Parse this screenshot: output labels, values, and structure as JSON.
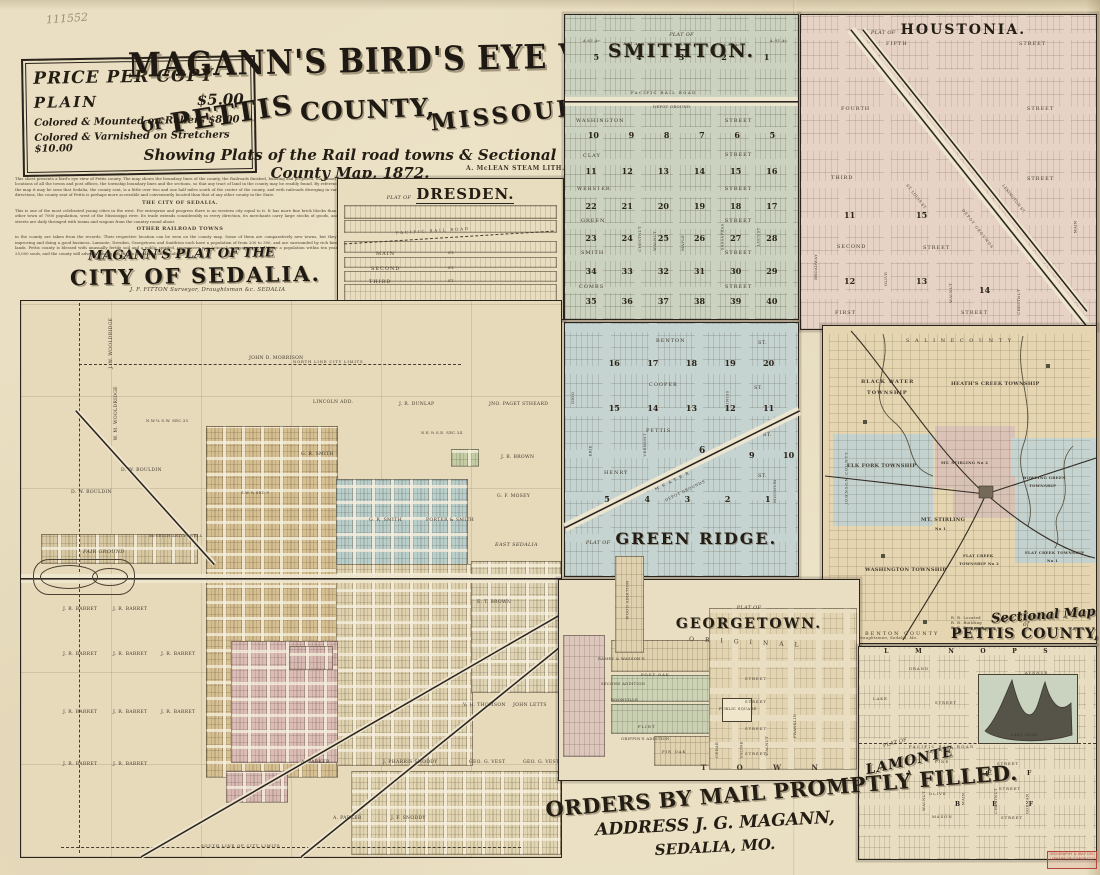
{
  "page": {
    "handwritten_number": "111552"
  },
  "price_box": {
    "title": "PRICE PER COPY",
    "plain_label": "PLAIN",
    "plain_price": "$5.00",
    "row2": "Colored & Mounted on Rollers  $8.00",
    "row3": "Colored & Varnished on Stretchers $10.00"
  },
  "title_block": {
    "main": "MAGANN'S BIRD'S EYE VIEW",
    "of": "OF",
    "pettis": "PETTIS",
    "county": "COUNTY,",
    "missouri": "MISSOURI",
    "subtitle": "Showing Plats of the Rail road towns & Sectional County Map, 1872.",
    "lith": "A. McLEAN STEAM LITH."
  },
  "description": {
    "para1": "This sheet presents a bird's eye view of Pettis county. The map shows the boundary lines of the county, the Railroads finished, building and proposed, the names and locations of all the towns and post offices, the township boundary lines and the sections, so that any tract of land in the county may be readily found. By reference to the map it may be seen that Sedalia, the county seat, is a little over two and one half miles south of the center of the county, and with railroads diverging in various directions, the county seat of Pettis is perhaps more accessible and conveniently located than that of any other county in the State.",
    "heading1": "THE CITY OF SEDALIA.",
    "para2": "This is one of the most celebrated young cities in the west. For enterprise and progress there is no western city equal to it. It has more fine brick blocks than any other town of 7000 population, west of the Mississippi river. Its trade extends considerably in every direction, its merchants carry large stocks of goods, and its streets are daily thronged with teams and wagons from the country round about.",
    "heading2": "OTHER RAILROAD TOWNS",
    "para3": "in the county are taken from the records. Their respective location can be seen on the county map. Some of them are comparatively new towns, but they are improving and doing a good business. Lamonte, Dresden, Georgetown and Smithton each have a population of from 200 to 300, and are surrounded by rich farming lands. Pettis county is blessed with unusually fertile soil and a public spirited, progressive population; her county seat will have a population within ten years of 25,000 souls, and the county will advance among the first in population and wealth."
  },
  "dresden": {
    "prefix": "PLAT OF",
    "title": "DRESDEN.",
    "railroad": "PACIFIC  RAIL  ROAD",
    "streets": [
      "MAIN",
      "SECOND",
      "THIRD"
    ],
    "st": "ST.",
    "west": "WESTERN DIVISION",
    "east": "EASTERN DIVISION"
  },
  "sedalia": {
    "t1": "MAGANN'S PLAT OF THE",
    "t2": "CITY OF SEDALIA.",
    "surveyor": "J. F. FITTON   Surveyor, Draughtsman &c.   SEDALIA",
    "labels": [
      "J. W. WOOLDRIDGE",
      "W. M. WOOLDRIDGE",
      "JOHN D. MORRISON",
      "NORTH LINE CITY LIMITS",
      "LINCOLN ADD.",
      "J. R. DUNLAP",
      "JNO. PAGET STHEARD",
      "G. R. SMITH",
      "J. B. BROWN",
      "D. W. BOULDIN",
      "D. W. BOULDIN",
      "G. R. SMITH",
      "PORTER & SMITH",
      "G. F. MOSEY",
      "EAST SEDALIA",
      "E. T. BROWN",
      "FAIR GROUND",
      "McVEIGH AND POWELL",
      "J. R. BARRET",
      "J. R. BARRET",
      "J. R. BARRET",
      "J. R. BARRET",
      "J. R. BARRET",
      "J. R. BARRET",
      "J. R. BARRET",
      "J. R. BARRET",
      "V. H. THOMSON",
      "JOHN LETTS",
      "A. PARKER",
      "J. PHARRIS SNODDY",
      "GEO. G. VEST",
      "GEO. G. VEST",
      "A. PARKER",
      "J. F. SNODDY",
      "SOUTH LINE OF CITY LIMITS",
      "N.W.¼ S.W. SEC.33",
      "N.E.¼ S.E. SEC.34",
      "S.W.¼ SEC.9",
      "J. R. BARRET",
      "J. R. BARRET"
    ]
  },
  "smithton": {
    "prefix": "PLAT OF",
    "title": "SMITHTON.",
    "railroad": "PACIFIC  RAIL  ROAD",
    "depot": "DEPOT GROUND",
    "acres": [
      "A.63 Ac.",
      "A.61 Ac.",
      "A.91 Ac.",
      "A.93 Ac."
    ],
    "rows": [
      [
        "5",
        "4",
        "3",
        "2",
        "1"
      ],
      [
        "10",
        "9",
        "8",
        "7",
        "6",
        "5"
      ],
      [
        "11",
        "12",
        "13",
        "14",
        "15",
        "16"
      ],
      [
        "22",
        "21",
        "20",
        "19",
        "18",
        "17"
      ],
      [
        "23",
        "24",
        "25",
        "26",
        "27",
        "28"
      ],
      [
        "34",
        "33",
        "32",
        "31",
        "30",
        "29"
      ],
      [
        "35",
        "36",
        "37",
        "38",
        "39",
        "40"
      ]
    ],
    "streets": [
      "WASHINGTON",
      "CLAY",
      "WEBSTER",
      "GREEN",
      "SMITH",
      "COMBS"
    ],
    "street_word": "STREET",
    "vstreets": [
      "CHESTNUT",
      "WALNUT",
      "MAPLE",
      "SASSAFRAS",
      "LOCUST"
    ]
  },
  "houstonia": {
    "prefix": "PLAT OF",
    "title": "HOUSTONIA.",
    "hstreets": [
      "FIFTH",
      "FOURTH",
      "THIRD",
      "SECOND",
      "FIRST"
    ],
    "street_word": "STREET",
    "vstreets": [
      "BROADWAY",
      "OLIVE",
      "WALNUT",
      "CHESTNUT",
      "MAIN"
    ],
    "depot": "DEPOT GROUNDS",
    "stlouis": "ST. LOUIS ST.",
    "lexington": "LEXINGTON ST.",
    "numbers": [
      "11",
      "12",
      "13",
      "14",
      "15"
    ]
  },
  "green_ridge": {
    "prefix": "PLAT OF",
    "title": "GREEN RIDGE.",
    "hstreets": [
      "BENTON",
      "COOPER",
      "PETTIS",
      "HENRY"
    ],
    "st": "ST.",
    "vstreets": [
      "OHIO",
      "ERIE",
      "VERMONT",
      "ILLINOIS",
      "MISSOURI"
    ],
    "rowA": [
      "16",
      "17",
      "18",
      "19",
      "20"
    ],
    "rowB": [
      "15",
      "14",
      "13",
      "12",
      "11"
    ],
    "rowC": [
      "6",
      "9",
      "10"
    ],
    "rowD": [
      "5",
      "4",
      "3",
      "2",
      "1"
    ],
    "rail": "M. K. & T. R. R.",
    "depot": "DEPOT GROUNDS"
  },
  "sectional": {
    "saline": "S A L I N E     C O U N T Y",
    "benton": "BENTON   COUNTY",
    "johnson": "JOHNSON  COUNTY",
    "cooper": "COOPER  COUNTY",
    "tw": {
      "bw1": "BLACK WATER",
      "bw2": "TOWNSHIP",
      "hc": "HEATH'S CREEK TOWNSHIP",
      "elk": "ELK  FORK  TOWNSHIP",
      "mt2": "MT. STIRLING No 2",
      "bg1": "BOWLING GREEN",
      "bg2": "TOWNSHIP",
      "mt1a": "MT. STIRLING",
      "mt1b": "No 1",
      "wash": "WASHINGTON TOWNSHIP",
      "fc2a": "FLAT CREEK",
      "fc2b": "TOWNSHIP No 2",
      "fc1a": "FLAT CREEK TOWNSHIP",
      "fc1b": "No 1"
    },
    "legend": [
      "R. R. Located",
      "R. R. Building",
      "R. R. Proposed"
    ],
    "credit": "Surveyor & Draughtsman, Sedalia, Mo.",
    "title1": "Sectional Map",
    "title_of": "of",
    "title2": "PETTIS COUNTY, MO."
  },
  "georgetown": {
    "prefix": "PLAT OF",
    "title": "GEORGETOWN.",
    "wood": "WOOD ADDITION",
    "ramey": "RAMEY & WASSON'S",
    "post_oak": "POST  OAK",
    "second_add": "SECOND ADDITION",
    "boonville": "BOONVILLE",
    "flint": "FLINT",
    "griffin": "GRIFFIN'S ADDITION",
    "pin_oak": "PIN  OAK",
    "public_square": "PUBLIC SQUARE",
    "original": "ORIGINAL",
    "vstreets": [
      "CEDAR",
      "SALINE",
      "WALNUT",
      "FRANKLIN"
    ],
    "street_word": "STREET",
    "town": "T O W N"
  },
  "lamonte": {
    "prefix": "PLAT OF",
    "title": "LAMONTE",
    "top_letters": [
      "L",
      "M",
      "N",
      "O",
      "P",
      "S"
    ],
    "grand": "GRAND",
    "lake": "LAKE",
    "pine": "PINE",
    "olive": "OLIVE",
    "mason": "MASON",
    "avenue": "AVENUE",
    "street_word": "STREET",
    "lake_shaw": "LAKE SHAW",
    "railroad": "PACIFIC  RAIL  ROAD",
    "vstreets": [
      "WALNUT",
      "MAIN",
      "CHESTNUT",
      "GORMAN"
    ],
    "letters_row1": [
      "A",
      "B",
      "E",
      "F"
    ],
    "letters_row2": [
      "B",
      "E",
      "F"
    ]
  },
  "orders": {
    "line1": "ORDERS BY MAIL PROMPTLY FILLED.",
    "line2": "ADDRESS  J. G. MAGANN,",
    "line3": "SEDALIA, MO."
  },
  "stamp": {
    "line1": "GEOGRAPHY & MAP DIV.",
    "line2": "LIBRARY OF CONGRESS"
  }
}
